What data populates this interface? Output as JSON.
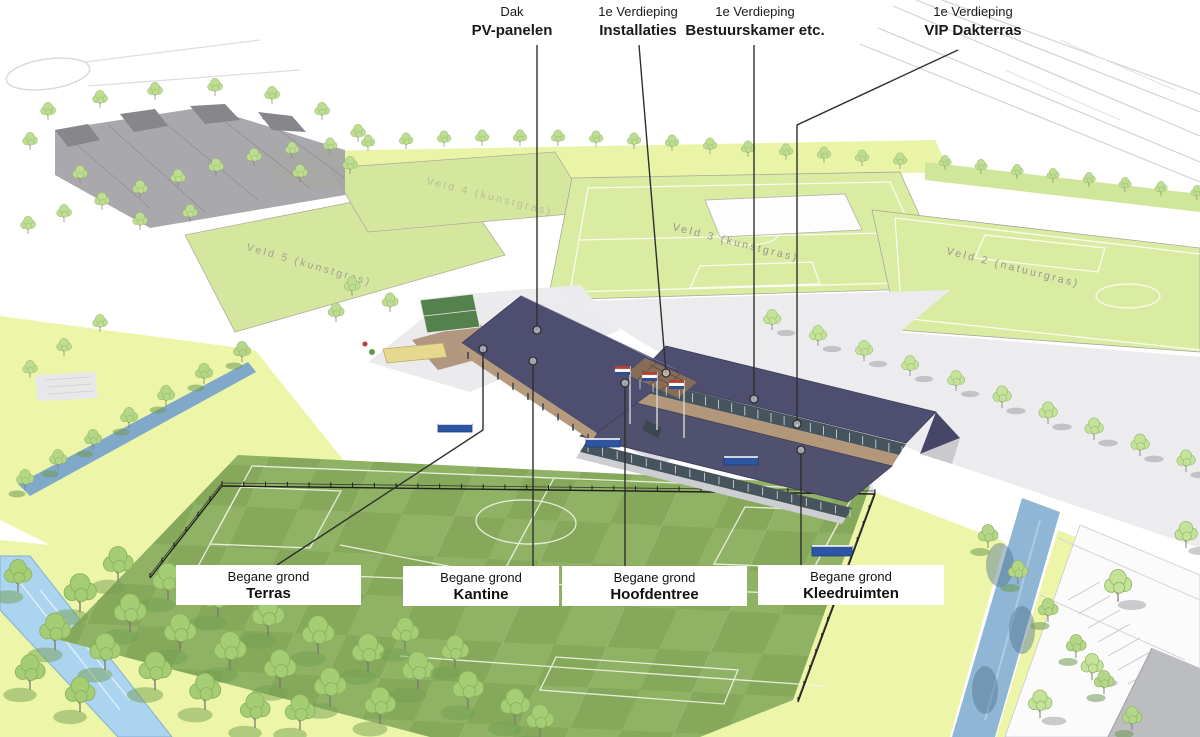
{
  "annotations": {
    "top": [
      {
        "line1": "Dak",
        "line2": "PV-panelen"
      },
      {
        "line1": "1e Verdieping",
        "line2": "Installaties"
      },
      {
        "line1": "1e Verdieping",
        "line2": "Bestuurskamer etc."
      },
      {
        "line1": "1e Verdieping",
        "line2": "VIP Dakterras"
      }
    ],
    "bottom": [
      {
        "line1": "Begane grond",
        "line2": "Terras"
      },
      {
        "line1": "Begane grond",
        "line2": "Kantine"
      },
      {
        "line1": "Begane grond",
        "line2": "Hoofdentree"
      },
      {
        "line1": "Begane grond",
        "line2": "Kleedruimten"
      }
    ]
  },
  "field_labels": [
    "Veld 5 (kunstgras)",
    "Veld 4 (kunstgras)",
    "Veld 3 (kunstgras)",
    "Veld 2 (natuurgras)"
  ],
  "colors": {
    "roof": "#4e4e71",
    "field_green_light": "#8fb264",
    "field_green_dark": "#85a85a",
    "upper_field_green": "#d9eca2",
    "tree_green": "#bedc92",
    "water_blue": "#a6d0ee",
    "canal_blue": "#8fb6d4",
    "terrace_brown": "#ab8e72",
    "flag_red": "#b5402f",
    "flag_blue": "#2d4f92",
    "leader_line": "#2f2f2f",
    "label_text": "#1a1a1a"
  }
}
